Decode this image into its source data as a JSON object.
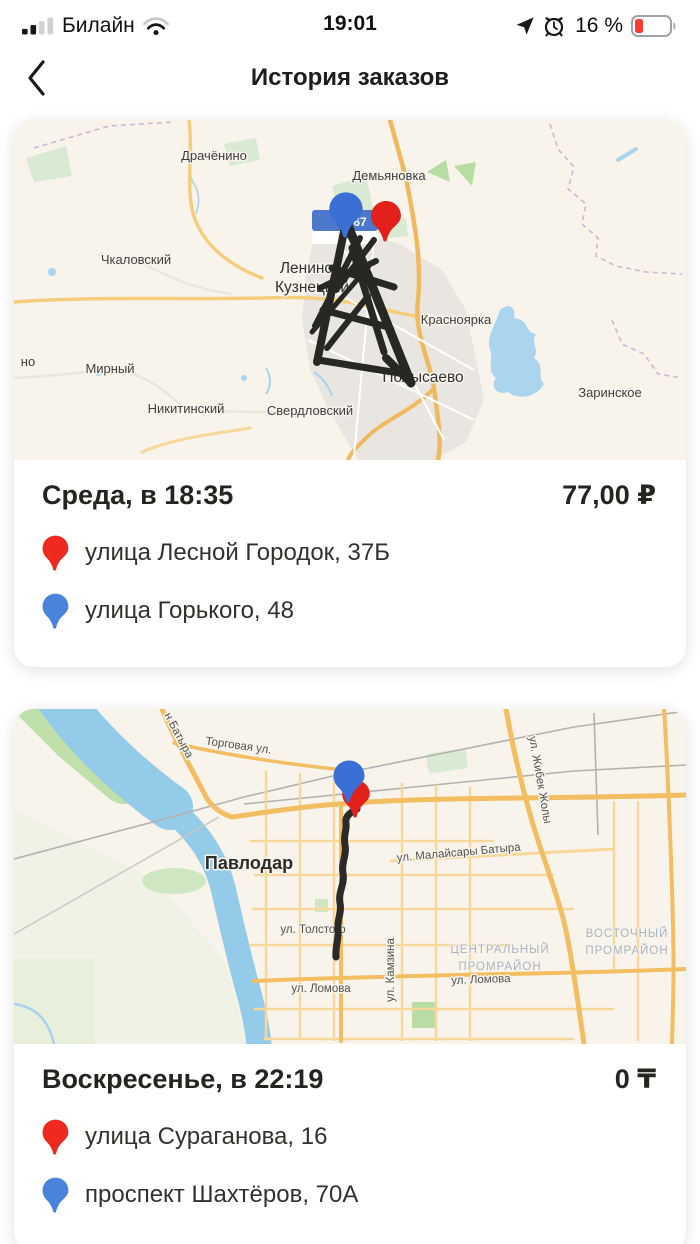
{
  "status_bar": {
    "carrier": "Билайн",
    "time": "19:01",
    "battery": "16 %"
  },
  "header": {
    "title": "История заказов"
  },
  "orders": [
    {
      "date": "Среда, в 18:35",
      "price": "77,00 ₽",
      "stops": [
        {
          "pin": "red",
          "address": "улица Лесной Городок, 37Б"
        },
        {
          "pin": "blue",
          "address": "улица Горького, 48"
        }
      ],
      "map_labels": {
        "drachenino": "Драчёнино",
        "demyanovka": "Демьяновка",
        "chkalovskiy": "Чкаловский",
        "leninsk_line1": "Ленинск-",
        "leninsk_line2": "Кузнецкий",
        "krasnoyarka": "Красноярка",
        "mirnyy": "Мирный",
        "left_edge_fragment": "но",
        "nikitinskiy": "Никитинский",
        "sverdlovskiy": "Свердловский",
        "polysaevo": "Полысаево",
        "zarinskoe": "Заринское",
        "road_shield": "67"
      }
    },
    {
      "date": "Воскресенье, в 22:19",
      "price": "0 ₸",
      "stops": [
        {
          "pin": "red",
          "address": "улица Сураганова, 16"
        },
        {
          "pin": "blue",
          "address": "проспект Шахтёров, 70А"
        }
      ],
      "map_labels": {
        "batyra": "н Батыра",
        "torgovaya": "Торговая ул.",
        "pavlodar": "Павлодар",
        "zhibek_zholy": "ул. Жибек Жолы",
        "malaysary_batyra": "ул. Малайсары Батыра",
        "tolstogo": "ул. Толстого",
        "kamzina": "ул. Камзина",
        "lomova_west": "ул. Ломова",
        "lomova_east": "ул. Ломова",
        "central_zone_line1": "ЦЕНТРАЛЬНЫЙ",
        "central_zone_line2": "ПРОМРАЙОН",
        "east_zone_line1": "ВОСТОЧНЫЙ",
        "east_zone_line2": "ПРОМРАЙОН"
      }
    }
  ],
  "colors": {
    "pin_red": "#ee2a20",
    "pin_blue": "#4a83db",
    "route": "#2a2927",
    "battery_low": "#ff3b30"
  }
}
